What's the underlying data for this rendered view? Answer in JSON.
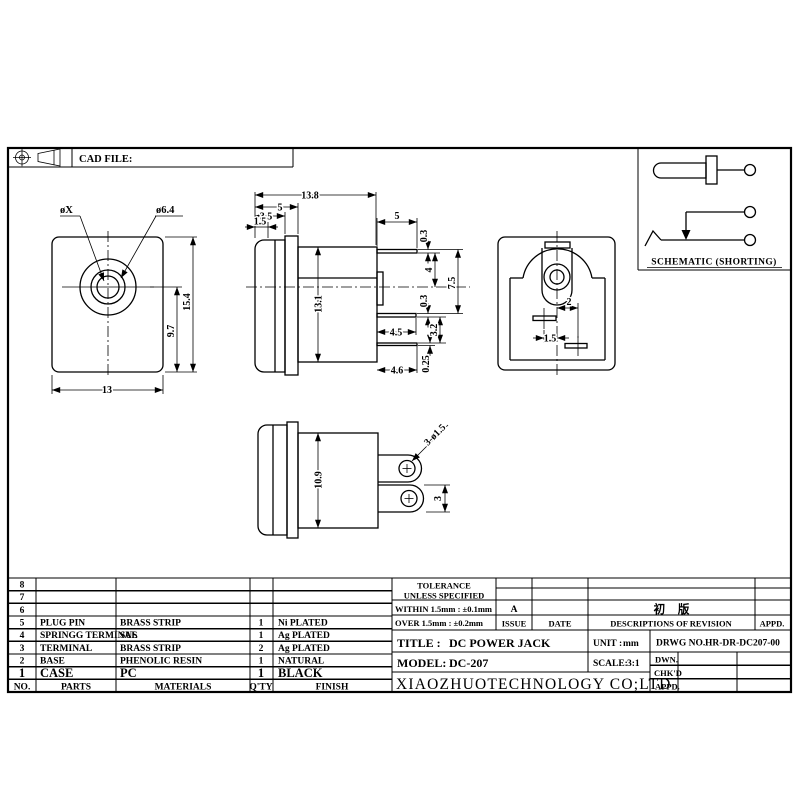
{
  "colors": {
    "line": "#000000",
    "background": "#ffffff"
  },
  "sheet": {
    "cad_file_label": "CAD FILE:",
    "schematic_label": "SCHEMATIC (SHORTING)"
  },
  "dims": {
    "front": {
      "pin_dia": "øX",
      "barrel_dia": "ø6.4",
      "height": "15.4",
      "center_to_bottom": "9.7",
      "width": "13"
    },
    "side": {
      "total_len": "13.8",
      "len5": "5",
      "len35": "3.5",
      "len15": "1.5",
      "body_h": "13.1",
      "pin_len": "5",
      "pin_th": "0.3",
      "pin_to_center": "4",
      "pin_span": "7.5",
      "mid_th": "0.3",
      "mid_len": "4.5",
      "term_gap": "3.2",
      "bot_len": "4.6",
      "bot_th": "0.25"
    },
    "rear": {
      "slot_right": "2",
      "slot_left": "1.5"
    },
    "bottom": {
      "body_h": "10.9",
      "holes": "3-ø1.5",
      "term_w": "3"
    }
  },
  "parts_table": {
    "headers": {
      "no": "NO.",
      "parts": "PARTS",
      "materials": "MATERIALS",
      "qty": "Q'TY",
      "finish": "FINISH"
    },
    "rows": [
      {
        "no": "8",
        "parts": "",
        "materials": "",
        "qty": "",
        "finish": ""
      },
      {
        "no": "7",
        "parts": "",
        "materials": "",
        "qty": "",
        "finish": ""
      },
      {
        "no": "6",
        "parts": "",
        "materials": "",
        "qty": "",
        "finish": ""
      },
      {
        "no": "5",
        "parts": "PLUG PIN",
        "materials": "BRASS STRIP",
        "qty": "1",
        "finish": "Ni PLATED"
      },
      {
        "no": "4",
        "parts": "SPRINGG TERMINAL",
        "materials": "SUS",
        "qty": "1",
        "finish": "Ag PLATED"
      },
      {
        "no": "3",
        "parts": "TERMINAL",
        "materials": "BRASS STRIP",
        "qty": "2",
        "finish": "Ag PLATED"
      },
      {
        "no": "2",
        "parts": "BASE",
        "materials": "PHENOLIC RESIN",
        "qty": "1",
        "finish": "NATURAL"
      },
      {
        "no": "1",
        "parts": "CASE",
        "materials": "PC",
        "qty": "1",
        "finish": "BLACK"
      }
    ]
  },
  "title_block": {
    "tolerance_title": "TOLERANCE",
    "tolerance_sub": "UNLESS  SPECIFIED",
    "tolerance_within": "WITHIN 1.5mm : ±0.1mm",
    "tolerance_over": "OVER 1.5mm : ±0.2mm",
    "issue_value": "A",
    "issue_label": "ISSUE",
    "date_label": "DATE",
    "revision_entry": "初 版",
    "revision_label": "DESCRIPTIONS OF REVISION",
    "revision_appd_label": "APPD.",
    "title_label": "TITLE :",
    "title_value": "DC POWER JACK",
    "unit_label": "UNIT :",
    "unit_value": "mm",
    "drwg_label": "DRWG NO.:",
    "drwg_value": "HR-DR-DC207-00",
    "model_label": "MODEL:",
    "model_value": "DC-207",
    "scale_label": "SCALE:",
    "scale_value": "3:1",
    "dwn_label": "DWN.",
    "chkd_label": "CHK'D",
    "appd_label": "APPD.",
    "company": "XIAOZHUOTECHNOLOGY CO;LTD"
  }
}
